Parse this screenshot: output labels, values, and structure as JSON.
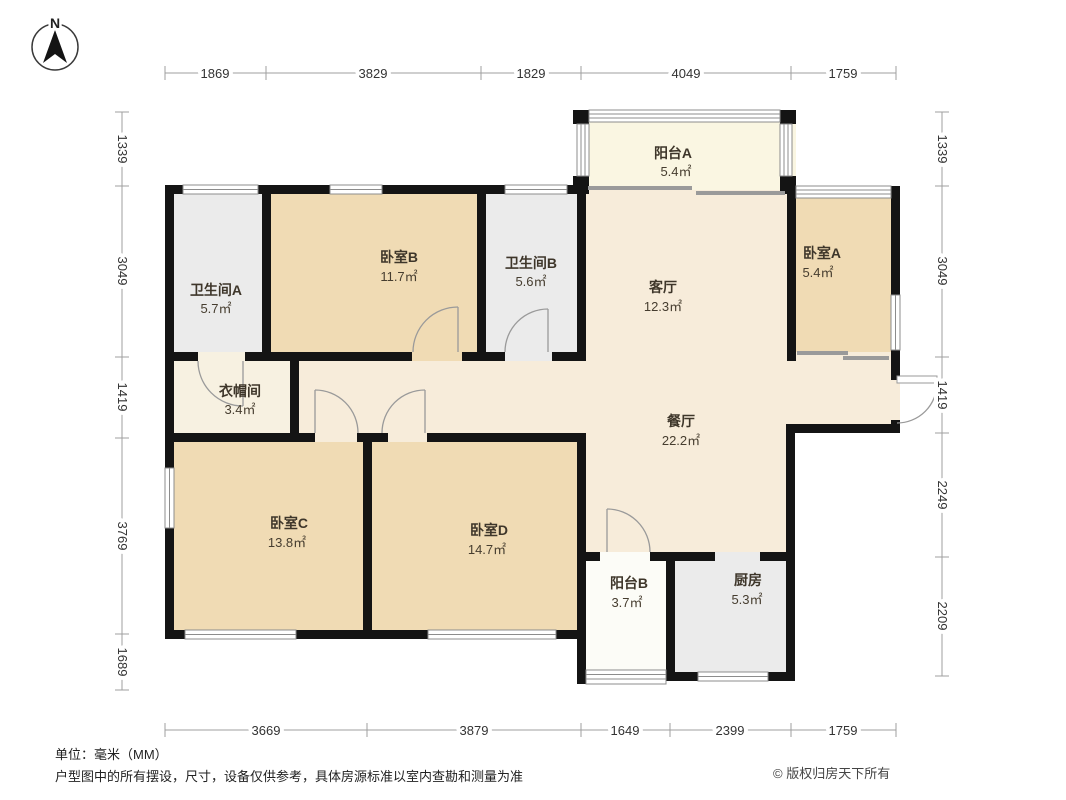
{
  "compass": {
    "north_label": "N"
  },
  "dimensions": {
    "unit": "mm",
    "top": [
      "1869",
      "3829",
      "1829",
      "4049",
      "1759"
    ],
    "bottom": [
      "3669",
      "3879",
      "1649",
      "2399",
      "1759"
    ],
    "left": [
      "1339",
      "3049",
      "1419",
      "3769",
      "1689"
    ],
    "right": [
      "1339",
      "3049",
      "1419",
      "2249",
      "2209"
    ]
  },
  "rooms": {
    "balcony_a": {
      "name": "阳台A",
      "area": "5.4㎡"
    },
    "bath_a": {
      "name": "卫生间A",
      "area": "5.7㎡"
    },
    "bedroom_b": {
      "name": "卧室B",
      "area": "11.7㎡"
    },
    "bath_b": {
      "name": "卫生间B",
      "area": "5.6㎡"
    },
    "living": {
      "name": "客厅",
      "area": "12.3㎡"
    },
    "bedroom_a": {
      "name": "卧室A",
      "area": "5.4㎡"
    },
    "cloakroom": {
      "name": "衣帽间",
      "area": "3.4㎡"
    },
    "dining": {
      "name": "餐厅",
      "area": "22.2㎡"
    },
    "bedroom_c": {
      "name": "卧室C",
      "area": "13.8㎡"
    },
    "bedroom_d": {
      "name": "卧室D",
      "area": "14.7㎡"
    },
    "balcony_b": {
      "name": "阳台B",
      "area": "3.7㎡"
    },
    "kitchen": {
      "name": "厨房",
      "area": "5.3㎡"
    }
  },
  "footer": {
    "unit": "单位：毫米（MM）",
    "disclaimer": "户型图中的所有摆设，尺寸，设备仅供参考，具体房源标准以室内查勘和测量为准",
    "copyright": "© 版权归房天下所有"
  },
  "colors": {
    "wall": "#141414",
    "bedroom_fill": "#F0DBB4",
    "living_fill": "#F7ECDA",
    "bath_kitchen_fill": "#EBEBEB",
    "balcony_a_fill": "#FAF6E2",
    "balcony_b_fill": "#FCFCF7",
    "cloakroom_fill": "#F7F1E1",
    "dim_text": "#333333"
  }
}
